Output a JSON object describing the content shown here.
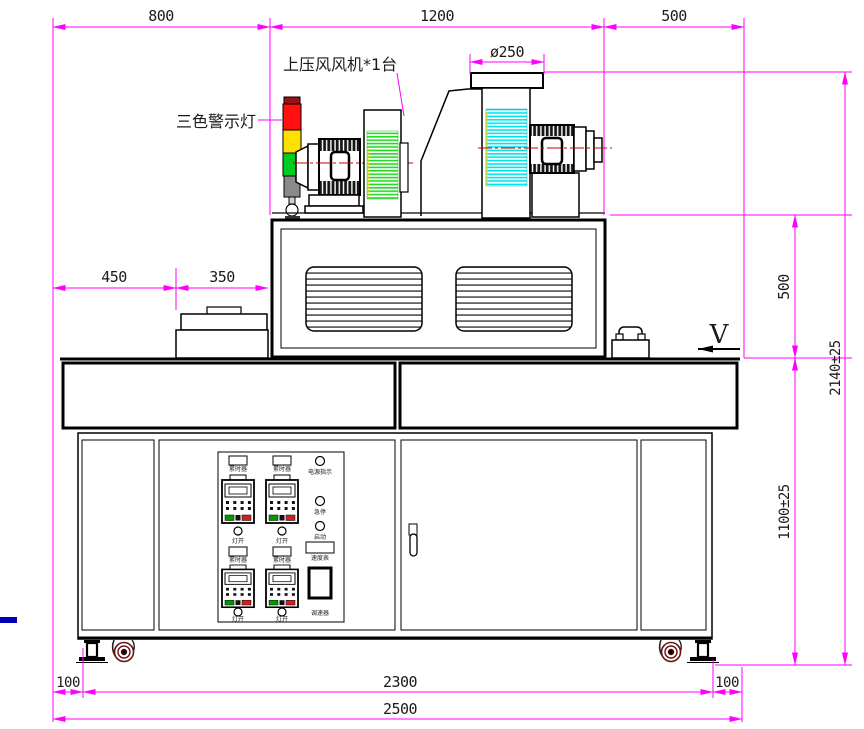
{
  "dims": {
    "top_800": "800",
    "top_1200": "1200",
    "top_500": "500",
    "dia": "ø250",
    "left_450": "450",
    "left_350": "350",
    "right_500": "500",
    "right_2140": "2140±25",
    "right_1100": "1100±25",
    "bottom_100_left": "100",
    "bottom_2300": "2300",
    "bottom_100_right": "100",
    "bottom_2500": "2500",
    "view": "V"
  },
  "labels": {
    "fan": "上压风风机*1台",
    "warning_light": "三色警示灯"
  },
  "panel": {
    "timer": "累时器",
    "lamp": "灯开",
    "power": "电源指示",
    "estop": "急停",
    "start": "启动",
    "meter": "速度表",
    "regulator": "调速器"
  },
  "colors": {
    "dimension": "#FF00FF",
    "centerline": "#CC0000",
    "light_red": "#FF1111",
    "light_yellow": "#FFE000",
    "light_green": "#00CC22",
    "fan_hatch_green": "#22DD22",
    "fan_hatch_cyan": "#00E5EE",
    "caster": "#6B1212",
    "accent_blue": "#0000BB"
  }
}
